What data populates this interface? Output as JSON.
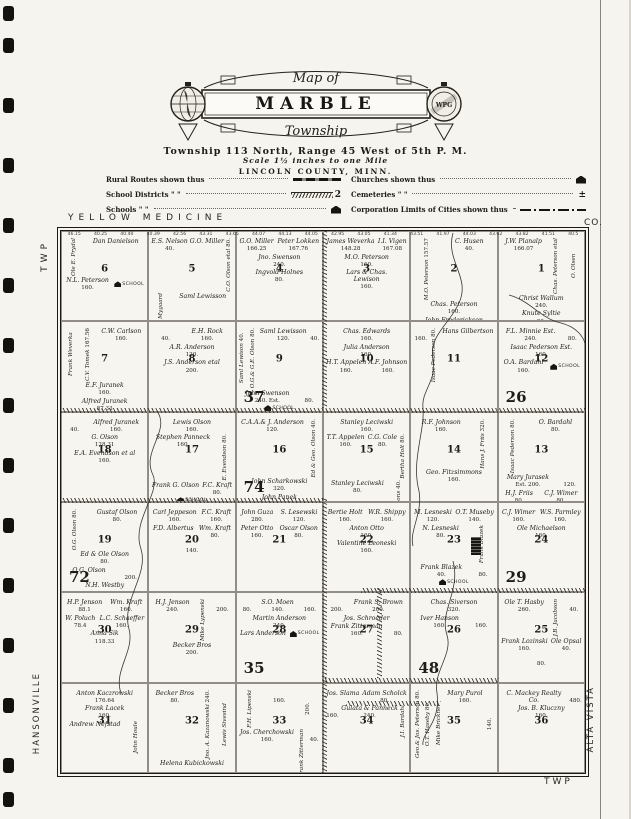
{
  "colors": {
    "paper": "#f5f4ef",
    "ink": "#1f1c18"
  },
  "page": {
    "binding_hole_y": [
      6,
      38,
      98,
      158,
      218,
      278,
      338,
      398,
      458,
      518,
      578,
      638,
      698,
      758,
      792
    ],
    "edge_labels": {
      "top": "YELLOW MEDICINE",
      "top_right": "CO.",
      "left_top": "TWP",
      "right_top": "TWP.",
      "left_bottom": "HANSONVILLE",
      "right_bottom": "ALTA VISTA",
      "bottom_right": "TWP"
    }
  },
  "title": {
    "map_of": "Map of",
    "name": "MARBLE",
    "township": "Township",
    "scale": "Scale 1½ inches to one Mile",
    "county": "LINCOLN COUNTY, MINN.",
    "township_line": "Township 113 North, Range 45 West of 5th P. M.",
    "seal_text": "WPG"
  },
  "legend": {
    "left": [
      {
        "label": "Rural Routes shown thus",
        "symbol": "rural-route-line"
      },
      {
        "label": "School Districts  \"    \"",
        "symbol": "school-district-line",
        "symbol_text": "2"
      },
      {
        "label": "Schools  \"    \"",
        "symbol": "school-icon"
      }
    ],
    "right": [
      {
        "label": "Churches shown thus",
        "symbol": "church-icon"
      },
      {
        "label": "Cemeteries  \"    \"",
        "symbol": "cemetery-cross",
        "symbol_text": "±"
      },
      {
        "label": "Corporation Limits of Cities shown thus",
        "symbol": "corporation-line"
      }
    ]
  },
  "map": {
    "school_label": "SCHOOL",
    "top_lot_acres": [
      "46.15",
      "40.25",
      "40.40",
      "40.39",
      "42.56",
      "43.31",
      "43.65",
      "44.07",
      "44.13",
      "44.05",
      "42.95",
      "43.05",
      "41.34",
      "43.51",
      "41.97",
      "44.03",
      "43.62",
      "43.82",
      "41.51",
      "40.5"
    ],
    "hatches": [
      {
        "x": 0,
        "y": 177,
        "w": 524,
        "h": 5
      },
      {
        "x": 0,
        "y": 267,
        "w": 262,
        "h": 5
      },
      {
        "x": 300,
        "y": 357,
        "w": 224,
        "h": 5
      },
      {
        "x": 262,
        "y": 447,
        "w": 176,
        "h": 5
      },
      {
        "x": 285,
        "y": 470,
        "w": 95,
        "h": 5
      },
      {
        "x": 261,
        "y": 0,
        "w": 5,
        "h": 177
      },
      {
        "x": 261,
        "y": 267,
        "w": 5,
        "h": 275
      },
      {
        "x": 316,
        "y": 357,
        "w": 5,
        "h": 90
      }
    ],
    "streams": [
      "M392,2 C384,30 410,46 398,72 C388,94 368,104 372,128 C376,150 360,160 362,177 C364,200 350,230 358,260 C362,282 348,300 352,315",
      "M448,64 C470,70 480,88 500,92 C516,96 522,106 524,112",
      "M392,330 C400,360 378,380 386,404 C392,424 372,440 376,462 C380,492 360,502 362,514",
      "M96,180 C110,200 80,220 92,244 C100,262 70,290 80,318 C88,344 60,370 68,398 C74,420 52,440 60,462"
    ],
    "sections": [
      {
        "n": 6,
        "school": true,
        "parcels": [
          {
            "t": "Ole E. Prydal",
            "v": 1
          },
          {
            "t": "Dan Danielson"
          },
          {
            "t": "N.L. Peterson",
            "a": "160."
          }
        ]
      },
      {
        "n": 5,
        "parcels": [
          {
            "t": "E.S. Nelson",
            "a": "40."
          },
          {
            "t": "G.O. Miller"
          },
          {
            "t": "C.O. Olson etal",
            "a": "80.",
            "v": 1
          },
          {
            "t": "Albert Mygaard",
            "v": 1
          },
          {
            "t": "Saml Lewisson"
          }
        ]
      },
      {
        "n": 4,
        "parcels": [
          {
            "t": "G.O. Miller",
            "a": "166.25"
          },
          {
            "t": "Peter Lokken",
            "a": "167.76"
          },
          {
            "t": "Jno. Swenson",
            "a": "240."
          },
          {
            "t": "Ingvold Holnes",
            "a": "80."
          }
        ]
      },
      {
        "n": 3,
        "parcels": [
          {
            "t": "James Weverka",
            "a": "148.28"
          },
          {
            "t": "I.I. Vigen",
            "a": "167.08"
          },
          {
            "t": "M.O. Peterson",
            "a": "160."
          },
          {
            "t": "Lars & Chas. Lewison",
            "a": "160."
          }
        ]
      },
      {
        "n": 2,
        "parcels": [
          {
            "t": "M.O. Peterson",
            "a": "157.57",
            "v": 1
          },
          {
            "t": "C. Husen",
            "a": "40."
          },
          {
            "t": "Chas. Peterson",
            "a": "160."
          },
          {
            "t": "John Frederickson",
            "a": "160."
          }
        ]
      },
      {
        "n": 1,
        "parcels": [
          {
            "t": "J.W. Planalp",
            "a": "166.07"
          },
          {
            "t": "Chas. Peterson etal",
            "v": 1
          },
          {
            "t": "O. Olsen",
            "v": 1
          },
          {
            "t": "Christ Wallum",
            "a": "240."
          },
          {
            "t": "Knute Syltie",
            "a": "80."
          }
        ]
      },
      {
        "n": 7,
        "parcels": [
          {
            "t": "Frank Weverka",
            "v": 1
          },
          {
            "t": "C.V. Tomek",
            "a": "167.56",
            "v": 1
          },
          {
            "t": "C.W. Carlson",
            "a": "160."
          },
          {
            "t": "E.F. Juranek",
            "a": "160."
          },
          {
            "t": "Alfred Juranek",
            "a": "87.33"
          }
        ]
      },
      {
        "n": 8,
        "parcels": [
          {
            "t": "",
            "a": "40."
          },
          {
            "t": "E.H. Rock",
            "a": "160."
          },
          {
            "t": "A.R. Anderson",
            "a": "120."
          },
          {
            "t": "J.S. Anderson etal",
            "a": "200."
          }
        ]
      },
      {
        "n": 9,
        "district": "37",
        "school": true,
        "parcels": [
          {
            "t": "Saml Lewison",
            "a": "40.",
            "v": 1
          },
          {
            "t": "O.G.& G.E. Olson",
            "a": "80.",
            "v": 1
          },
          {
            "t": "Saml Lewisson",
            "a": "120."
          },
          {
            "t": "",
            "a": "40."
          },
          {
            "t": "John Swenson",
            "a": "240. Est."
          },
          {
            "t": "",
            "a": "80."
          }
        ]
      },
      {
        "n": 10,
        "parcels": [
          {
            "t": "Chas. Edwards",
            "a": "160."
          },
          {
            "t": "Julia Anderson",
            "a": "160."
          },
          {
            "t": "H.T. Appelen",
            "a": "160."
          },
          {
            "t": "A.F. Johnson",
            "a": "160."
          }
        ]
      },
      {
        "n": 11,
        "parcels": [
          {
            "t": "",
            "a": "160."
          },
          {
            "t": "Isaac Pederson",
            "a": "80.",
            "v": 1
          },
          {
            "t": "Hans Gilbertson"
          }
        ]
      },
      {
        "n": 12,
        "district": "26",
        "school": true,
        "parcels": [
          {
            "t": "F.L. Minnie Est.",
            "a": "240."
          },
          {
            "t": "",
            "a": "80."
          },
          {
            "t": "Isaac Pederson Est.",
            "a": "160."
          },
          {
            "t": "O.A. Bardahl",
            "a": "160."
          }
        ]
      },
      {
        "n": 18,
        "parcels": [
          {
            "t": "",
            "a": "40."
          },
          {
            "t": "Alfred Juranek",
            "a": "160."
          },
          {
            "t": "G. Olson",
            "a": "128.31"
          },
          {
            "t": "E.A. Evendson et al",
            "a": "160."
          }
        ]
      },
      {
        "n": 17,
        "school": true,
        "parcels": [
          {
            "t": "Lewis Olson",
            "a": "160."
          },
          {
            "t": "Stephen Panneck",
            "a": "160."
          },
          {
            "t": "E. Evendson",
            "a": "80.",
            "v": 1
          },
          {
            "t": "Frank G. Olson"
          },
          {
            "t": "F.C. Kraft",
            "a": "80."
          }
        ]
      },
      {
        "n": 16,
        "district": "74",
        "parcels": [
          {
            "t": "C.A.A.& J. Anderson",
            "a": "120."
          },
          {
            "t": "Ed & Geo. Olson",
            "a": "40.",
            "v": 1
          },
          {
            "t": "John Scharkowski",
            "a": "320."
          },
          {
            "t": "John Panek",
            "a": "80."
          }
        ]
      },
      {
        "n": 15,
        "parcels": [
          {
            "t": "Stanley Leciwski",
            "a": "160."
          },
          {
            "t": "T.T. Appelen",
            "a": "160."
          },
          {
            "t": "C.G. Cole",
            "a": "80."
          },
          {
            "t": "Bertha Holt",
            "a": "80.",
            "v": 1
          },
          {
            "t": "Stanley Leciwski",
            "a": "80."
          },
          {
            "t": "Geo. Fitzsimmons",
            "a": "40.",
            "v": 1
          }
        ]
      },
      {
        "n": 14,
        "parcels": [
          {
            "t": "R.F. Johnson",
            "a": "160."
          },
          {
            "t": "Hans J. Friis",
            "a": "320.",
            "v": 1
          },
          {
            "t": "Geo. Fitzsimmons",
            "a": "160."
          }
        ]
      },
      {
        "n": 13,
        "parcels": [
          {
            "t": "Isaac Pederson",
            "a": "80.",
            "v": 1
          },
          {
            "t": "O. Bardahl",
            "a": "80."
          },
          {
            "t": "Mary Jurasek",
            "a": "Est. 200."
          },
          {
            "t": "",
            "a": "120."
          },
          {
            "t": "H.J. Friis",
            "a": "80."
          },
          {
            "t": "C.J. Wimer",
            "a": "80."
          },
          {
            "t": "Lars Wilhelmson"
          }
        ]
      },
      {
        "n": 19,
        "district": "72",
        "parcels": [
          {
            "t": "O.G. Olson",
            "a": "80.",
            "v": 1
          },
          {
            "t": "Gustaf Olson",
            "a": "80."
          },
          {
            "t": "Ed & Ole Olson",
            "a": "80."
          },
          {
            "t": "O.G. Olson"
          },
          {
            "t": "",
            "a": "200."
          },
          {
            "t": "N.H. Westby"
          }
        ]
      },
      {
        "n": 20,
        "parcels": [
          {
            "t": "Carl Jeppeson",
            "a": "160."
          },
          {
            "t": "F.C. Kraft",
            "a": "160."
          },
          {
            "t": "F.D. Albertus"
          },
          {
            "t": "Wm. Kraft",
            "a": "80."
          },
          {
            "t": "",
            "a": "140."
          }
        ]
      },
      {
        "n": 21,
        "parcels": [
          {
            "t": "John Guza",
            "a": "280."
          },
          {
            "t": "S. Lesewski",
            "a": "120."
          },
          {
            "t": "Peter Otto",
            "a": "160."
          },
          {
            "t": "Oscar Olson",
            "a": "80."
          }
        ]
      },
      {
        "n": 22,
        "parcels": [
          {
            "t": "Bertie Holt",
            "a": "160."
          },
          {
            "t": "W.R. Shippy",
            "a": "160."
          },
          {
            "t": "Anton Otto",
            "a": "160."
          },
          {
            "t": "Valentine Leoneski",
            "a": "160."
          }
        ]
      },
      {
        "n": 23,
        "school": true,
        "village": true,
        "parcels": [
          {
            "t": "M. Lesneski",
            "a": "120."
          },
          {
            "t": "O.T. Museby",
            "a": "140."
          },
          {
            "t": "N. Lesneski",
            "a": "80."
          },
          {
            "t": "Frank Blazek",
            "v": 1
          },
          {
            "t": "Frank Blazek",
            "a": "40."
          },
          {
            "t": "",
            "a": "80."
          }
        ]
      },
      {
        "n": 24,
        "district": "29",
        "parcels": [
          {
            "t": "C.J. Wimer",
            "a": "160."
          },
          {
            "t": "W.S. Parmley",
            "a": "160."
          },
          {
            "t": "Ole Michaelson",
            "a": "160."
          }
        ]
      },
      {
        "n": 30,
        "parcels": [
          {
            "t": "H.P. Jenson",
            "a": "88.1"
          },
          {
            "t": "Wm. Kraft",
            "a": "160."
          },
          {
            "t": "W. Poluch",
            "a": "78.4"
          },
          {
            "t": "L.C. Schaeffer",
            "a": "160."
          },
          {
            "t": "Anna Sik",
            "a": "118.33"
          }
        ]
      },
      {
        "n": 29,
        "parcels": [
          {
            "t": "H.J. Jenson",
            "a": "240."
          },
          {
            "t": "Mike Lypenski",
            "v": 1
          },
          {
            "t": "",
            "a": "200."
          },
          {
            "t": "Becker Bros",
            "a": "200."
          }
        ]
      },
      {
        "n": 28,
        "district": "35",
        "school": true,
        "parcels": [
          {
            "t": "",
            "a": "80."
          },
          {
            "t": "S.O. Moen",
            "a": "140."
          },
          {
            "t": "",
            "a": "160."
          },
          {
            "t": "Martin Anderson",
            "a": "240."
          },
          {
            "t": "Lars Anderson"
          }
        ]
      },
      {
        "n": 27,
        "parcels": [
          {
            "t": "",
            "a": "200."
          },
          {
            "t": "Frank S. Brown",
            "a": "200."
          },
          {
            "t": "Jos. Schroeder"
          },
          {
            "t": "Frank Zitterman",
            "a": "160."
          },
          {
            "t": "",
            "a": "80."
          }
        ]
      },
      {
        "n": 26,
        "district": "48",
        "parcels": [
          {
            "t": "Chas. Siverson",
            "a": "320."
          },
          {
            "t": "Iver Hanson",
            "a": "160."
          },
          {
            "t": "",
            "a": "160."
          }
        ]
      },
      {
        "n": 25,
        "parcels": [
          {
            "t": "Ole T. Hasby",
            "a": "260."
          },
          {
            "t": "J.B. Jacobson",
            "v": 1
          },
          {
            "t": "",
            "a": "40."
          },
          {
            "t": "Frank Lozinski",
            "a": "160."
          },
          {
            "t": "Ole Opsal",
            "a": "40."
          },
          {
            "t": "",
            "a": "80."
          }
        ]
      },
      {
        "n": 31,
        "parcels": [
          {
            "t": "Anton Kaczrowski",
            "a": "176.64"
          },
          {
            "t": "Frank Lacek",
            "a": "160."
          },
          {
            "t": "Andrew Nefstad"
          },
          {
            "t": "John Houle",
            "v": 1
          }
        ]
      },
      {
        "n": 32,
        "parcels": [
          {
            "t": "Becker Bros",
            "a": "80."
          },
          {
            "t": "Jno. A. Kazanowski",
            "a": "240.",
            "v": 1
          },
          {
            "t": "Lewis Sivesind",
            "v": 1
          },
          {
            "t": "Helena Kubickowski"
          }
        ]
      },
      {
        "n": 33,
        "parcels": [
          {
            "t": "F.H. Lipenski",
            "v": 1
          },
          {
            "t": "",
            "a": "160."
          },
          {
            "t": "",
            "a": "200.",
            "v": 1
          },
          {
            "t": "Jos. Cherchowski",
            "a": "160."
          },
          {
            "t": "Frank Zitterman",
            "v": 1
          },
          {
            "t": "",
            "a": "40."
          }
        ]
      },
      {
        "n": 34,
        "parcels": [
          {
            "t": "Jos. Slama"
          },
          {
            "t": "Adam Scholck",
            "a": "80."
          },
          {
            "t": "",
            "a": "160."
          },
          {
            "t": "Gulata & Panneck",
            "a": "240."
          },
          {
            "t": "J.I. Bardahl",
            "v": 1
          }
        ]
      },
      {
        "n": 35,
        "parcels": [
          {
            "t": "Geo.& Jos. Peterson",
            "a": "80.",
            "v": 1
          },
          {
            "t": "O.T. Haseby",
            "a": "80.",
            "v": 1
          },
          {
            "t": "Mike Brickner",
            "v": 1
          },
          {
            "t": "Mary Purol",
            "a": "160."
          },
          {
            "t": "",
            "a": "140.",
            "v": 1
          }
        ]
      },
      {
        "n": 36,
        "parcels": [
          {
            "t": "C. Mackey Realty Co."
          },
          {
            "t": "",
            "a": "480."
          },
          {
            "t": "Jos. B. Kluczny",
            "a": "160."
          }
        ]
      }
    ]
  }
}
